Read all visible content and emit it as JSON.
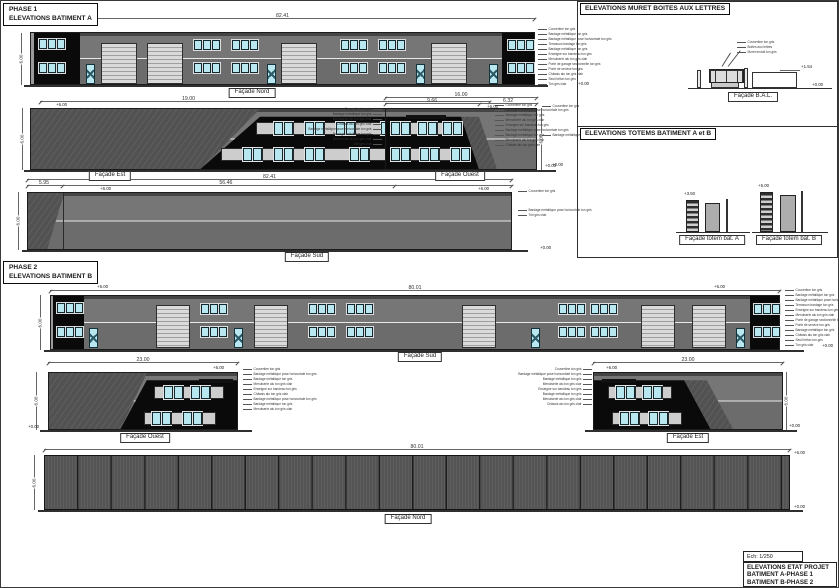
{
  "headers": {
    "phase1": [
      "PHASE 1",
      "ELEVATIONS BATIMENT A"
    ],
    "phase2": [
      "PHASE 2",
      "ELEVATIONS BATIMENT B"
    ],
    "muret": "ELEVATIONS MURET BOITES AUX LETTRES",
    "totems": "ELEVATIONS TOTEMS BATIMENT A et B"
  },
  "titleblock": {
    "scale": "Ech: 1/250",
    "lines": [
      "ELEVATIONS ETAT PROJET",
      "BATIMENT A-PHASE 1",
      "BATIMENT B-PHASE 2"
    ]
  },
  "labels": {
    "p1nord": "Façade Nord",
    "p1est": "Façade Est",
    "p1ouest": "Façade Ouest",
    "p1sud": "Façade Sud",
    "p2sud": "Façade Sud",
    "p2ouest": "Façade Ouest",
    "p2est": "Façade Est",
    "p2nord": "Façade Nord",
    "bal": "Façade B.A.L.",
    "totemA": "Façade totem bât. A",
    "totemB": "Façade totem bât. B"
  },
  "dims": {
    "p1nord_total": "82.41",
    "p1est_total": "19.00",
    "p1ouest_total": "16.00",
    "p1ouest_a": "9.66",
    "p1ouest_b": "6.32",
    "p1sud_total": "82.41",
    "p1sud_a": "5.95",
    "p1sud_b": "56.46",
    "p2sud_total": "80.01",
    "p2ouest_total": "23.00",
    "p2est_total": "23.00",
    "p2nord_total": "80.01",
    "height": "6.00"
  },
  "levels": {
    "top": "+6.00",
    "ground": "+0.00",
    "muret_top": "+1.54",
    "totemA": "+3.50",
    "totemB": "+5.00"
  },
  "leaders": {
    "p1nord": [
      "Couvertine ton gris",
      "Bardage métallique ton gris",
      "Bardage métallique pose horizontale ton gris",
      "Terrasson bardage ton gris",
      "Bardage métallique ton gris",
      "Enseigne sur bandeau ton gris",
      "Menuiserie alu ton gris clair",
      "Porte de garage sectionnelle ton gris",
      "Porte de service ton gris",
      "Châssis alu ton gris clair",
      "Seuil béton ton gris",
      "Ton gris clair"
    ],
    "p1est": [
      "Couvertine ton gris",
      "Bardage métallique pose horizontale ton gris",
      "Bardage métallique ton gris",
      "Menuiserie alu ton gris clair",
      "Enseigne sur bandeau ton gris",
      "Bardage métallique pose horizontale ton gris",
      "Bardage métallique ton gris",
      "Menuiserie alu ton gris clair",
      "Châssis alu ton gris clair"
    ],
    "p1ouest_left": [
      "Couvertine ton gris",
      "Bardage métallique ton gris",
      "Menuiserie alu ton gris clair",
      "Châssis alu ton gris clair",
      "Bardage métallique pose horizontale ton gris",
      "Bardage métallique ton gris",
      "Menuiserie alu ton gris clair",
      "Ton gris clair"
    ],
    "p1ouest_r1": [
      "Couvertine ton gris"
    ],
    "p1ouest_r2": [
      "Bardage métallique pose horizontale ton gris"
    ],
    "p1sud_r1": [
      "Couvertine ton gris"
    ],
    "p1sud_r2": [
      "Bardage métallique pose horizontale ton gris",
      "Ton gris clair"
    ],
    "p2sud": [
      "Couvertine ton gris",
      "Bardage métallique ton gris",
      "Bardage métallique pose horizontale ton gris",
      "Terrasson bardage ton gris",
      "Enseigne sur bandeau ton gris",
      "Menuiserie alu ton gris clair",
      "Porte de garage sectionnelle ton gris",
      "Porte de service ton gris",
      "Bardage métallique ton gris",
      "Châssis alu ton gris clair",
      "Seuil béton ton gris",
      "Ton gris clair"
    ],
    "p2ouest": [
      "Couvertine ton gris",
      "Bardage métallique pose horizontale ton gris",
      "Bardage métallique ton gris",
      "Menuiserie alu ton gris clair",
      "Enseigne sur bandeau ton gris",
      "Châssis alu ton gris clair",
      "Bardage métallique pose horizontale ton gris",
      "Bardage métallique ton gris",
      "Menuiserie alu ton gris clair"
    ],
    "p2est": [
      "Couvertine ton gris",
      "Bardage métallique pose horizontale ton gris",
      "Bardage métallique ton gris",
      "Menuiserie alu ton gris clair",
      "Enseigne sur bandeau ton gris",
      "Bardage métallique ton gris",
      "Menuiserie alu ton gris clair",
      "Châssis alu ton gris clair"
    ],
    "muret": [
      "Couvertine ton gris",
      "Boîtes aux lettres",
      "Muret enduit ton gris"
    ]
  },
  "colors": {
    "facade_gray": "#767676",
    "facade_gray_dark": "#6c6c6c",
    "dark_section": "#0a0a0a",
    "window_glass": "#b9e7ef",
    "garage_light": "#dadada",
    "hatch_gray": "#585858",
    "nord_b_gray": "#545454"
  }
}
